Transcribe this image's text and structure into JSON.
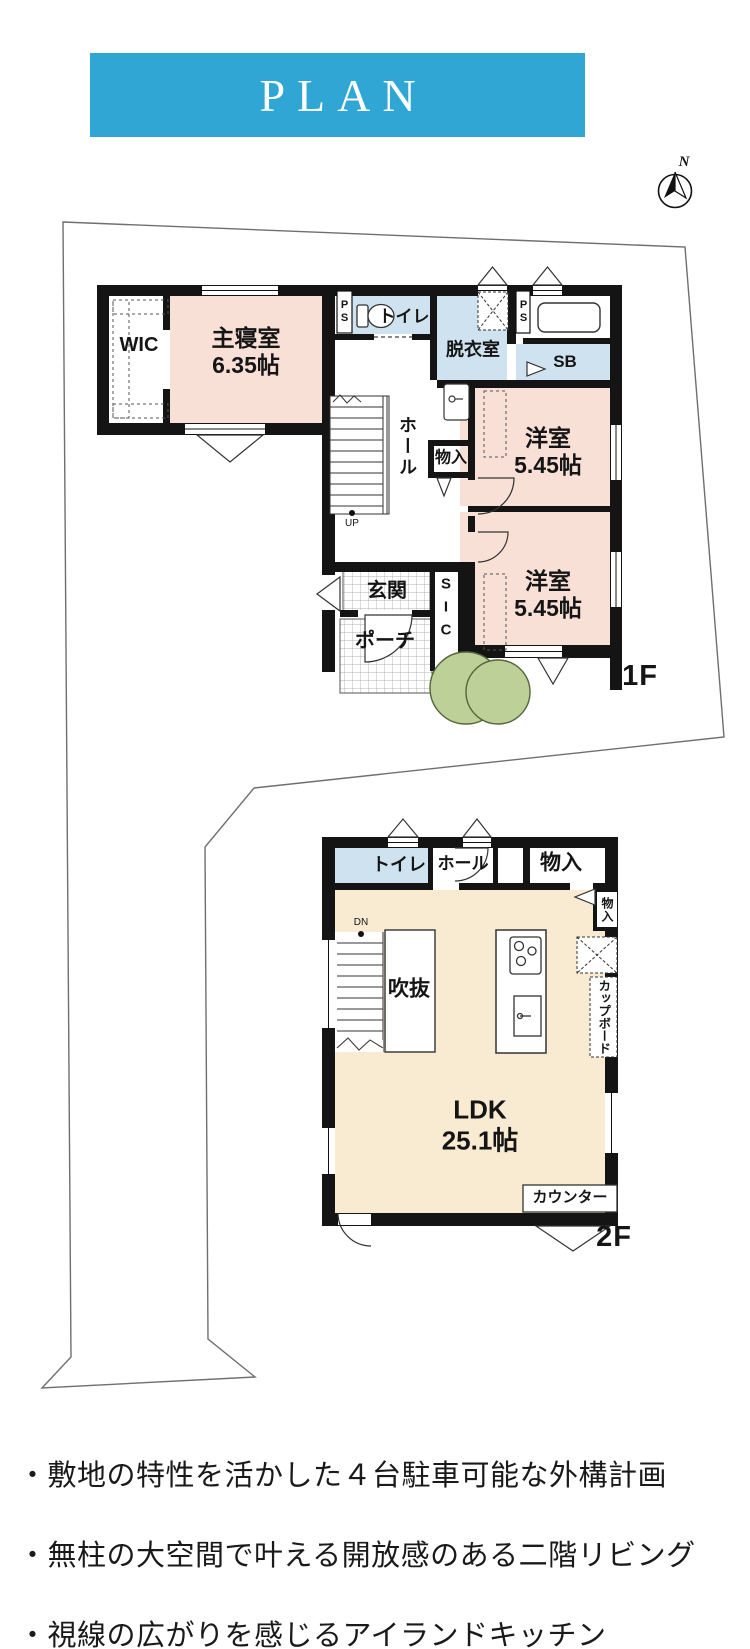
{
  "header": {
    "title": "PLAN"
  },
  "compass": {
    "north": "N"
  },
  "floor1": {
    "label": "1F",
    "wic": "WIC",
    "master": "主寝室\n6.35帖",
    "toilet": "トイレ",
    "ps_left": "PS",
    "ps_right": "PS",
    "dressing": "脱衣室",
    "shoebox": "SB",
    "hall": "ホール",
    "storage": "物入",
    "west_room_1": "洋室\n5.45帖",
    "west_room_2": "洋室\n5.45帖",
    "entrance": "玄関",
    "porch": "ポーチ",
    "sic": "SIC",
    "up": "UP"
  },
  "floor2": {
    "label": "2F",
    "toilet": "トイレ",
    "hall": "ホール",
    "storage_top": "物入",
    "storage_side": "物入",
    "void": "吹抜",
    "cupboard": "カップボード",
    "ldk": "LDK\n25.1帖",
    "counter": "カウンター",
    "dn": "DN"
  },
  "notes": {
    "items": [
      "・敷地の特性を活かした４台駐車可能な外構計画",
      "・無柱の大空間で叶える開放感のある二階リビング",
      "・視線の広がりを感じるアイランドキッチン"
    ]
  },
  "colors": {
    "accent_blue": "#2fa6d3",
    "room_pink": "#f9e0d7",
    "room_blue": "#cfe2ef",
    "room_cream": "#f8ebd2",
    "tree_green": "#bdd097",
    "wall_black": "#141414"
  }
}
